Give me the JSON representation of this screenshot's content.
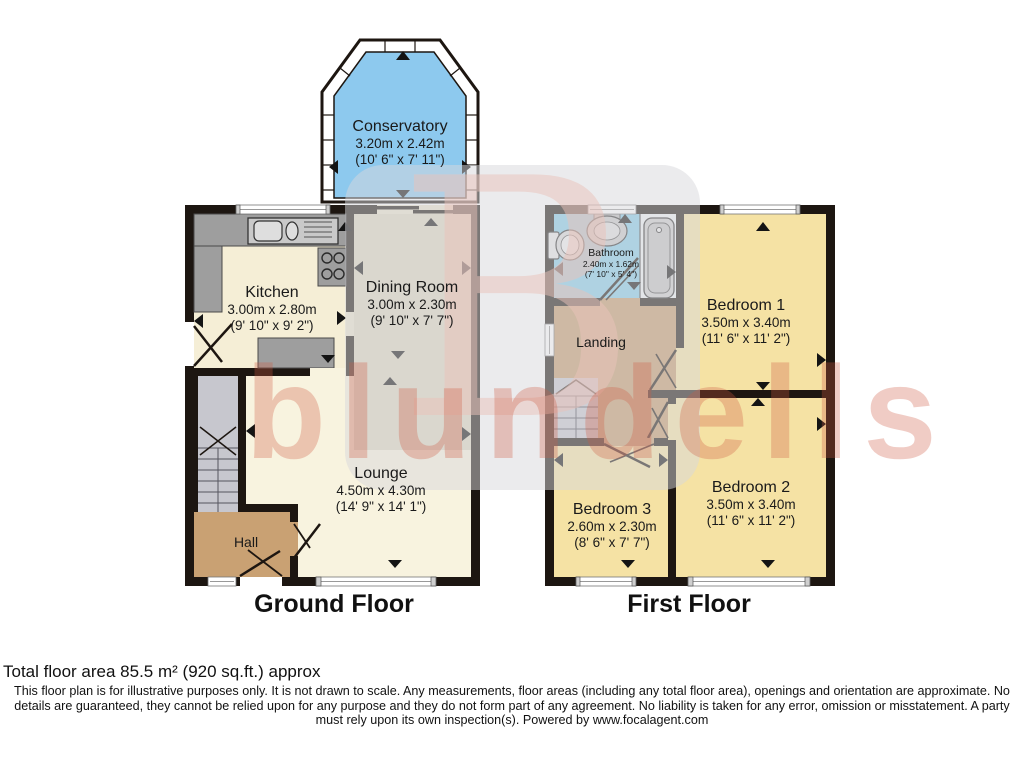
{
  "watermark": {
    "logo_letter": "B",
    "brand": "blundells"
  },
  "floors": {
    "ground": {
      "title": "Ground Floor"
    },
    "first": {
      "title": "First Floor"
    }
  },
  "rooms": {
    "conservatory": {
      "name": "Conservatory",
      "metric": "3.20m x 2.42m",
      "imperial": "(10' 6\" x 7' 11\")"
    },
    "kitchen": {
      "name": "Kitchen",
      "metric": "3.00m x 2.80m",
      "imperial": "(9' 10\" x 9' 2\")"
    },
    "dining": {
      "name": "Dining Room",
      "metric": "3.00m x 2.30m",
      "imperial": "(9' 10\" x 7' 7\")"
    },
    "lounge": {
      "name": "Lounge",
      "metric": "4.50m x 4.30m",
      "imperial": "(14' 9\" x 14' 1\")"
    },
    "hall": {
      "name": "Hall"
    },
    "bathroom": {
      "name": "Bathroom",
      "metric": "2.40m x 1.62m",
      "imperial": "(7' 10\" x 5' 4\")"
    },
    "landing": {
      "name": "Landing"
    },
    "bedroom1": {
      "name": "Bedroom 1",
      "metric": "3.50m x 3.40m",
      "imperial": "(11' 6\" x 11' 2\")"
    },
    "bedroom2": {
      "name": "Bedroom 2",
      "metric": "3.50m x 3.40m",
      "imperial": "(11' 6\" x 11' 2\")"
    },
    "bedroom3": {
      "name": "Bedroom 3",
      "metric": "2.60m x 2.30m",
      "imperial": "(8' 6\" x 7' 7\")"
    }
  },
  "footer": {
    "area": "Total floor area 85.5 m² (920 sq.ft.) approx",
    "disclaimer_line1": "This floor plan is for illustrative purposes only. It is not drawn to scale. Any measurements, floor areas (including any total floor area), openings and orientation are approximate. No",
    "disclaimer_line2": "details are guaranteed, they cannot be relied upon for any purpose and they do not form part of any agreement. No liability is taken for any error, omission or misstatement. A party",
    "disclaimer_line3": "must rely upon its own inspection(s). Powered by www.focalagent.com"
  },
  "colors": {
    "wall": "#1d1611",
    "conservatory_blue": "#8dc9ee",
    "bathroom_blue": "#86cce9",
    "bedroom_yellow": "#f5e2a4",
    "landing_tan": "#c49a6c",
    "hall_tan": "#c9a173",
    "kitchen_cream": "#f5eed6",
    "dining_beige": "#dcd6c0",
    "lounge_cream": "#f8f3df",
    "stairs_grey": "#c7c7ce",
    "watermark_pink": "#cf5a42"
  }
}
